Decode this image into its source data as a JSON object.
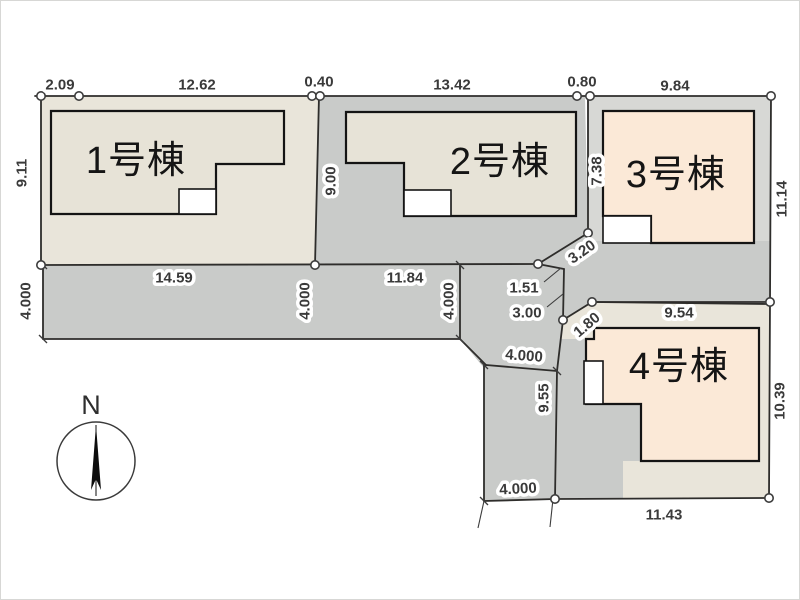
{
  "site_plan": {
    "title": "4-lot residential site plan",
    "buildings": [
      {
        "label": "1号棟",
        "x": 135,
        "y": 160
      },
      {
        "label": "2号棟",
        "x": 499,
        "y": 161
      },
      {
        "label": "3号棟",
        "x": 675,
        "y": 174
      },
      {
        "label": "4号棟",
        "x": 678,
        "y": 366
      }
    ],
    "dimensions": [
      {
        "text": "2.09",
        "x": 59,
        "y": 84,
        "rot": 0
      },
      {
        "text": "12.62",
        "x": 196,
        "y": 84,
        "rot": 0
      },
      {
        "text": "0.40",
        "x": 318,
        "y": 81,
        "rot": 0
      },
      {
        "text": "13.42",
        "x": 451,
        "y": 84,
        "rot": 0
      },
      {
        "text": "0.80",
        "x": 581,
        "y": 81,
        "rot": 0
      },
      {
        "text": "9.84",
        "x": 674,
        "y": 85,
        "rot": 0
      },
      {
        "text": "9.11",
        "x": 21,
        "y": 172,
        "rot": -90
      },
      {
        "text": "4.000",
        "x": 25,
        "y": 300,
        "rot": -90
      },
      {
        "text": "14.59",
        "x": 173,
        "y": 277,
        "rot": 0
      },
      {
        "text": "4.000",
        "x": 304,
        "y": 300,
        "rot": -90
      },
      {
        "text": "9.00",
        "x": 330,
        "y": 180,
        "rot": -90
      },
      {
        "text": "11.84",
        "x": 404,
        "y": 277,
        "rot": 0
      },
      {
        "text": "4.000",
        "x": 448,
        "y": 300,
        "rot": -90
      },
      {
        "text": "1.51",
        "x": 523,
        "y": 287,
        "rot": 0
      },
      {
        "text": "3.00",
        "x": 526,
        "y": 312,
        "rot": 0
      },
      {
        "text": "3.20",
        "x": 581,
        "y": 251,
        "rot": -35
      },
      {
        "text": "1.80",
        "x": 586,
        "y": 324,
        "rot": -40
      },
      {
        "text": "7.38",
        "x": 596,
        "y": 170,
        "rot": -90
      },
      {
        "text": "11.14",
        "x": 781,
        "y": 198,
        "rot": -90
      },
      {
        "text": "9.54",
        "x": 678,
        "y": 312,
        "rot": 0
      },
      {
        "text": "10.39",
        "x": 779,
        "y": 400,
        "rot": -90
      },
      {
        "text": "9.55",
        "x": 543,
        "y": 397,
        "rot": -90
      },
      {
        "text": "4.000",
        "x": 523,
        "y": 355,
        "rot": 4
      },
      {
        "text": "4.000",
        "x": 517,
        "y": 488,
        "rot": -3
      },
      {
        "text": "11.43",
        "x": 663,
        "y": 514,
        "rot": 0
      }
    ],
    "compass": {
      "north_label": "N"
    },
    "colors": {
      "lot_cream": "#e9e5da",
      "building_cream": "#e7e3d7",
      "building_peach": "#fbe9d7",
      "roadway_gray": "#c9cbc9",
      "lot3_gray": "#d7d8d5",
      "white": "#ffffff",
      "line_dark": "#2e2d2b"
    }
  }
}
